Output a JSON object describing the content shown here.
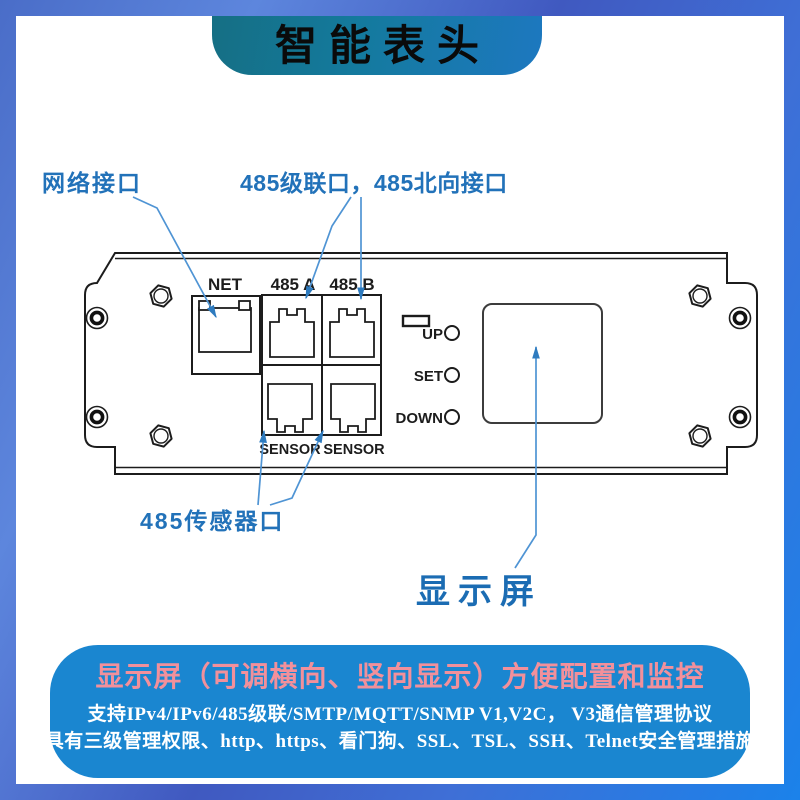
{
  "header": {
    "title": "智能表头"
  },
  "callouts": {
    "network": "网络接口",
    "cascade": "485级联口，485北向接口",
    "sensor": "485传感器口",
    "display": "显示屏"
  },
  "panel": {
    "port_labels": [
      "NET",
      "485 A",
      "485 B"
    ],
    "sensor_labels": [
      "SENSOR",
      "SENSOR"
    ],
    "button_labels": [
      "UP",
      "SET",
      "DOWN"
    ]
  },
  "footer": {
    "title": "显示屏（可调横向、竖向显示）方便配置和监控",
    "line1": "支持IPv4/IPv6/485级联/SMTP/MQTT/SNMP V1,V2C， V3通信管理协议",
    "line2": "具有三级管理权限、http、https、看门狗、SSL、TSL、SSH、Telnet安全管理措施"
  },
  "colors": {
    "frame_blue": "#4a6dc8",
    "banner_teal": "#156f84",
    "banner_blue": "#1d78c0",
    "footer_bg": "#1a86d0",
    "footer_title_pink": "#f2909b",
    "callout_blue": "#2272b9",
    "arrow_blue": "#4f94d4",
    "line_black": "#1c1c1c"
  }
}
